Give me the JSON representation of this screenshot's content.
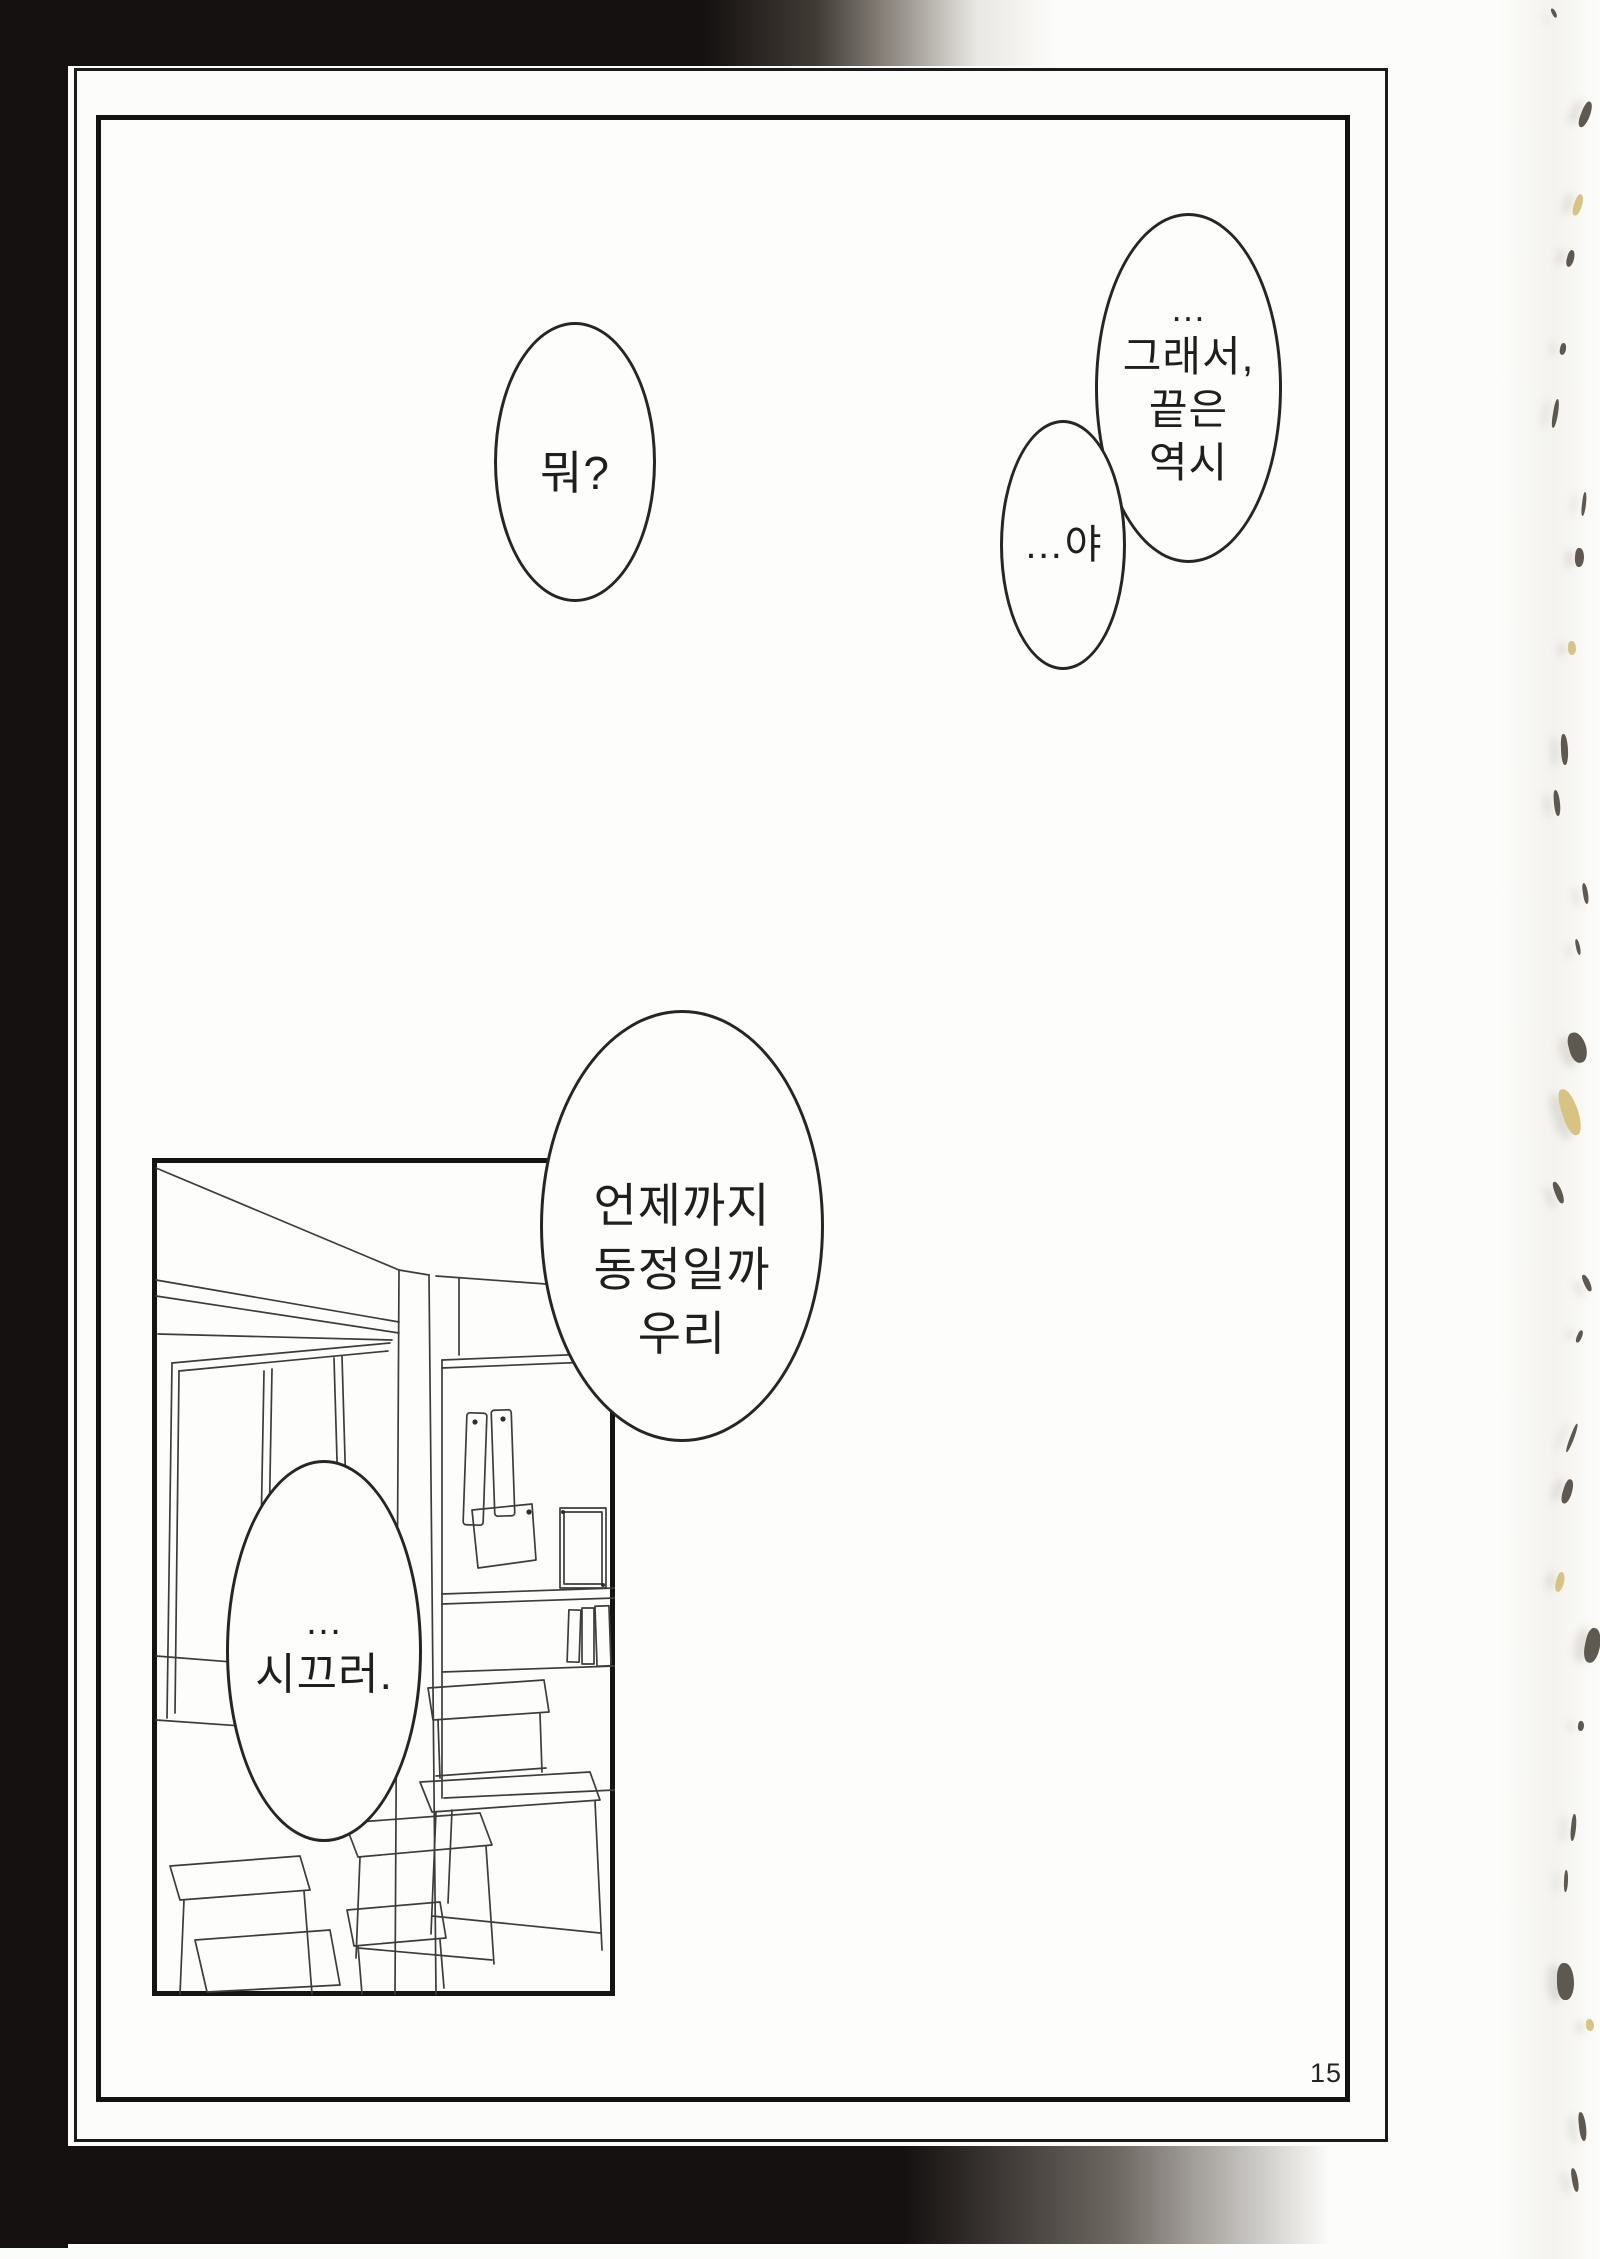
{
  "page": {
    "number": "15"
  },
  "bubbles": {
    "top_right": {
      "lines": [
        "…",
        "그래서,",
        "끝은",
        "역시"
      ]
    },
    "ya": {
      "lines": [
        "…야"
      ]
    },
    "mwo": {
      "lines": [
        "뭐?"
      ]
    },
    "virgin": {
      "lines": [
        "언제까지",
        "동정일까",
        "우리"
      ]
    },
    "noisy": {
      "lines": [
        "…",
        "시끄러."
      ]
    }
  },
  "colors": {
    "ink": "#1f1f1f",
    "paper": "#fcfcfa",
    "scan_black": "#151110",
    "artifact_dark": "#433d34",
    "artifact_yellow": "#d3bc6e"
  }
}
